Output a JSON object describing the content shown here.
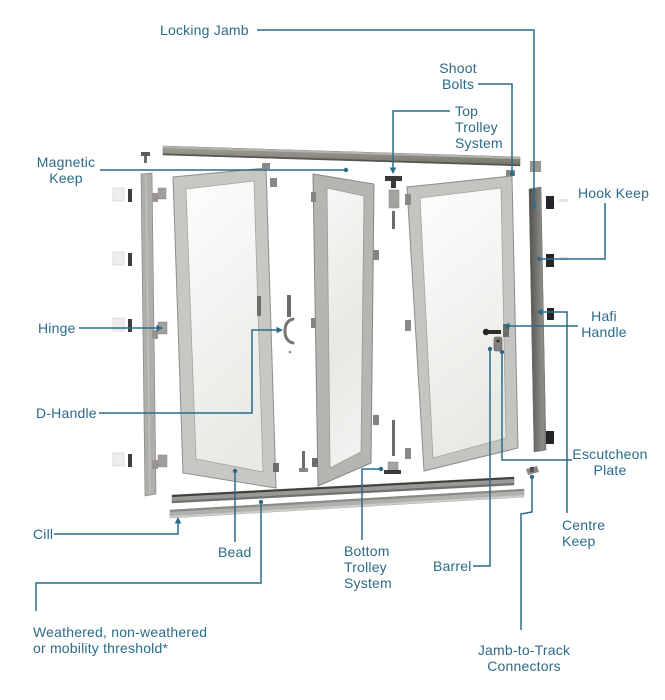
{
  "diagram": {
    "type": "exploded-parts-diagram",
    "subject": "Bifold door system parts diagram",
    "colors": {
      "accent": "#2b6b89",
      "frame_gray": "#c6c6c2",
      "track_gray": "#8f8d88",
      "jamb_dark": "#5f5d59",
      "glass": "#f3f3f1"
    },
    "labels": [
      {
        "id": "locking-jamb",
        "text": "Locking Jamb"
      },
      {
        "id": "shoot-bolts",
        "text": "Shoot\nBolts"
      },
      {
        "id": "top-trolley-system",
        "text": "Top\nTrolley\nSystem"
      },
      {
        "id": "magnetic-keep",
        "text": "Magnetic\nKeep"
      },
      {
        "id": "hook-keep",
        "text": "Hook Keep"
      },
      {
        "id": "hinge",
        "text": "Hinge"
      },
      {
        "id": "hafi-handle",
        "text": "Hafi\nHandle"
      },
      {
        "id": "d-handle",
        "text": "D-Handle"
      },
      {
        "id": "escutcheon-plate",
        "text": "Escutcheon\nPlate"
      },
      {
        "id": "centre-keep",
        "text": "Centre\nKeep"
      },
      {
        "id": "cill",
        "text": "Cill"
      },
      {
        "id": "bead",
        "text": "Bead"
      },
      {
        "id": "bottom-trolley-system",
        "text": "Bottom\nTrolley\nSystem"
      },
      {
        "id": "barrel",
        "text": "Barrel"
      },
      {
        "id": "threshold",
        "text": "Weathered, non-weathered\nor mobility threshold*"
      },
      {
        "id": "jamb-to-track-connectors",
        "text": "Jamb-to-Track\nConnectors"
      }
    ]
  }
}
